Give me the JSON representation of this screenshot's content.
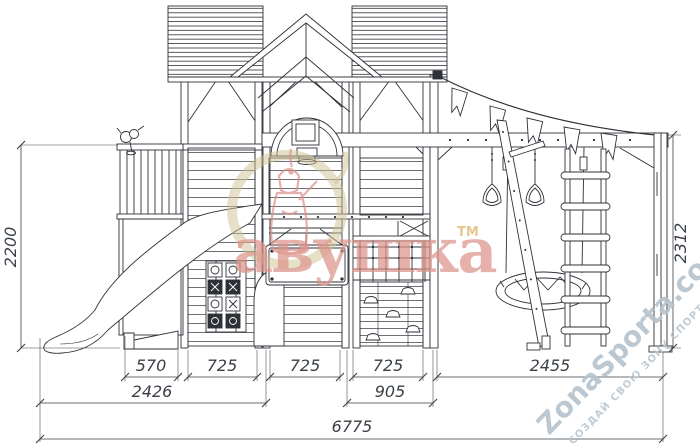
{
  "dimensions": {
    "left_height": "2200",
    "right_height": "2312",
    "bottom_row1": [
      "570",
      "725",
      "725",
      "725",
      "2455"
    ],
    "bottom_row2": [
      "2426",
      "905"
    ],
    "overall_width": "6775"
  },
  "watermarks": {
    "brand_text": "авушка",
    "brand_tm": "ТМ",
    "brand_color": "#dd948c",
    "brand_tm_color": "#e2bd7c",
    "brand_badge_color": "#d0c294",
    "site_name": "ZonaSporta.com",
    "site_slogan": "СОЗДАЙ СВОЮ ЗОНУ СПОРТА",
    "site_color": "#b5c3cd"
  },
  "style": {
    "line_color": "#2e3238",
    "dim_color": "#3a4047",
    "background": "#ffffff"
  }
}
